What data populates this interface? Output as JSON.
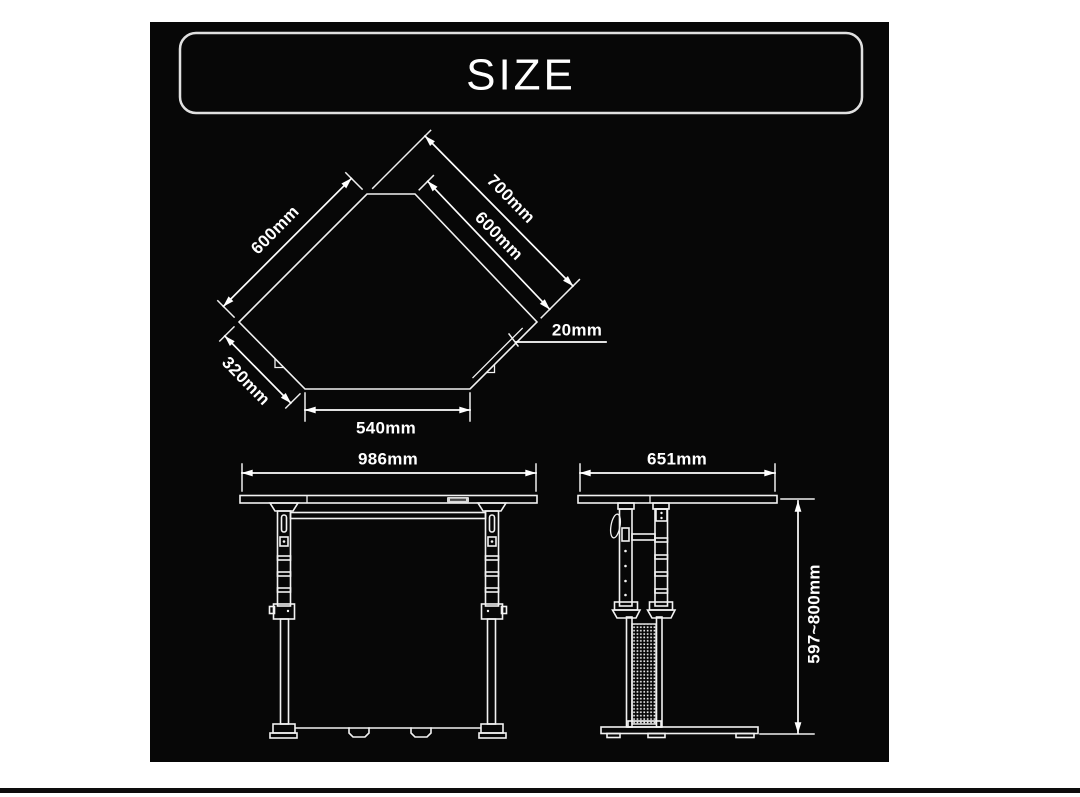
{
  "title": "SIZE",
  "colors": {
    "page_background": "#ffffff",
    "panel_background": "#070707",
    "line": "#f2f2f2",
    "text": "#ffffff",
    "title_border": "#e0e0e0",
    "footer_rule": "#0d0d0d"
  },
  "top_view": {
    "label_upper_left_edge": "600mm",
    "label_overall_right": "700mm",
    "label_upper_right_edge": "600mm",
    "label_edge_thickness": "20mm",
    "label_lower_left_edge": "320mm",
    "label_bottom_edge": "540mm"
  },
  "front_view": {
    "label_width": "986mm"
  },
  "side_view": {
    "label_depth": "651mm",
    "label_height_range": "597~800mm"
  }
}
